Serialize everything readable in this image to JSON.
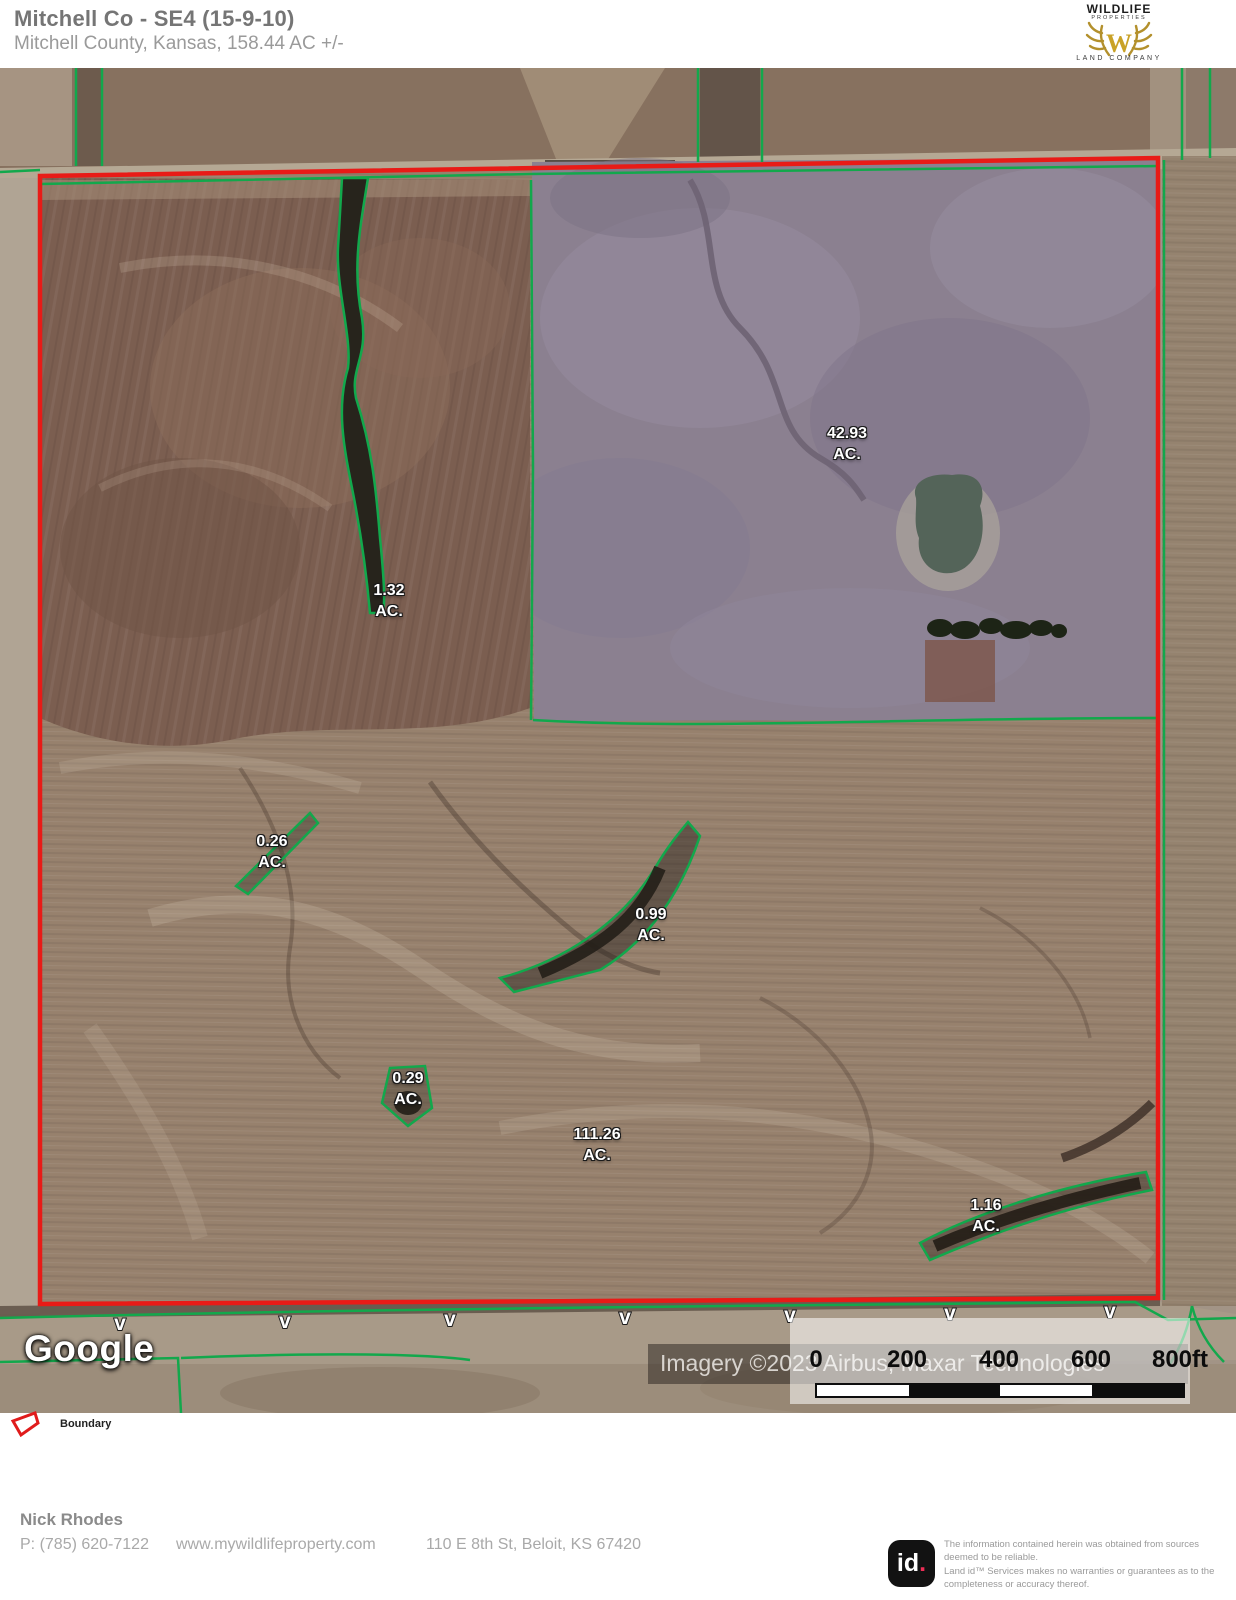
{
  "header": {
    "title": "Mitchell Co - SE4 (15-9-10)",
    "subtitle": "Mitchell County, Kansas, 158.44 AC +/-",
    "logo": {
      "line1": "WILDLIFE",
      "line2": "PROPERTIES",
      "monogram": "W",
      "line3": "LAND COMPANY"
    }
  },
  "map": {
    "parcels": [
      {
        "value": "42.93",
        "unit": "AC."
      },
      {
        "value": "1.32",
        "unit": "AC."
      },
      {
        "value": "0.26",
        "unit": "AC."
      },
      {
        "value": "0.99",
        "unit": "AC."
      },
      {
        "value": "0.29",
        "unit": "AC."
      },
      {
        "value": "111.26",
        "unit": "AC."
      },
      {
        "value": "1.16",
        "unit": "AC."
      }
    ],
    "road_mark": "v",
    "attribution": {
      "provider": "Google",
      "imagery": "Imagery ©2023 Airbus, Maxar Technologies"
    },
    "scale": {
      "ticks": [
        "0",
        "200",
        "400",
        "600",
        "800ft"
      ]
    }
  },
  "legend": {
    "items": [
      {
        "label": "Boundary",
        "color": "#e01b1b"
      }
    ]
  },
  "footer": {
    "agent": "Nick Rhodes",
    "phone": "P: (785) 620-7122",
    "website": "www.mywildlifeproperty.com",
    "address": "110 E 8th St, Beloit, KS 67420",
    "brand": "id",
    "brand_dot": ".",
    "disclaimer1": "The information contained herein was obtained from sources deemed to be reliable.",
    "disclaimer2": "Land id™ Services makes no warranties or guarantees as to the completeness or accuracy thereof."
  },
  "colors": {
    "boundary": "#e81b17",
    "field_line": "#12a84c"
  }
}
